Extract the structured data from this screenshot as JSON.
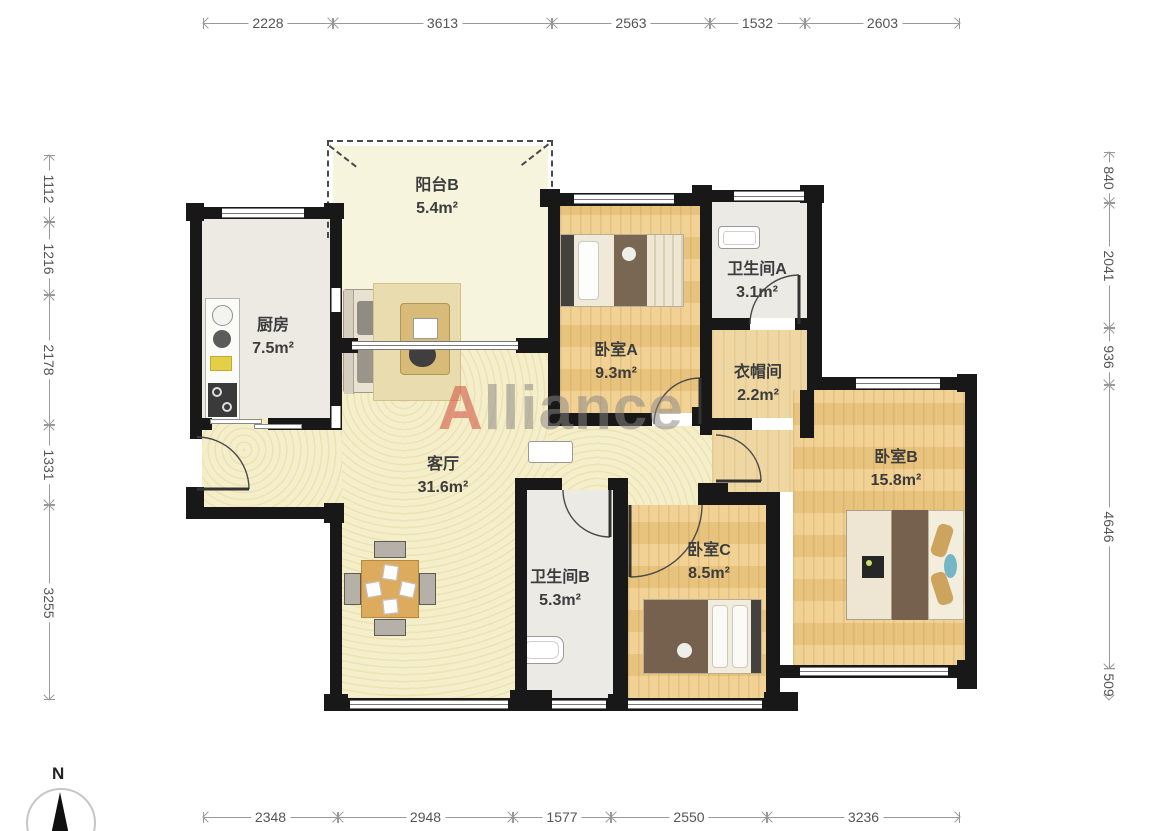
{
  "floor_plan": {
    "watermark": {
      "first_letter": "A",
      "rest": "lliance"
    },
    "compass": {
      "label": "N"
    },
    "rooms": {
      "balcony_b": {
        "name": "阳台B",
        "area": "5.4m²"
      },
      "kitchen": {
        "name": "厨房",
        "area": "7.5m²"
      },
      "living": {
        "name": "客厅",
        "area": "31.6m²"
      },
      "bedroom_a": {
        "name": "卧室A",
        "area": "9.3m²"
      },
      "bathroom_a": {
        "name": "卫生间A",
        "area": "3.1m²"
      },
      "closet": {
        "name": "衣帽间",
        "area": "2.2m²"
      },
      "bedroom_b": {
        "name": "卧室B",
        "area": "15.8m²"
      },
      "bathroom_b": {
        "name": "卫生间B",
        "area": "5.3m²"
      },
      "bedroom_c": {
        "name": "卧室C",
        "area": "8.5m²"
      }
    },
    "dimensions_mm": {
      "top": [
        "2228",
        "3613",
        "2563",
        "1532",
        "2603"
      ],
      "bottom": [
        "2348",
        "2948",
        "1577",
        "2550",
        "3236"
      ],
      "left": [
        "1112",
        "1216",
        "2178",
        "1331",
        "3255"
      ],
      "right": [
        "840",
        "2041",
        "936",
        "4646",
        "509"
      ]
    },
    "colors": {
      "wall": "#181818",
      "wood_floor": "#ecc883",
      "living_floor": "#f4eecb",
      "bath_floor": "#ebeae4",
      "balcony_floor": "#f7f4de",
      "watermark_red": "#d05846",
      "watermark_gray": "#8a8782"
    }
  }
}
